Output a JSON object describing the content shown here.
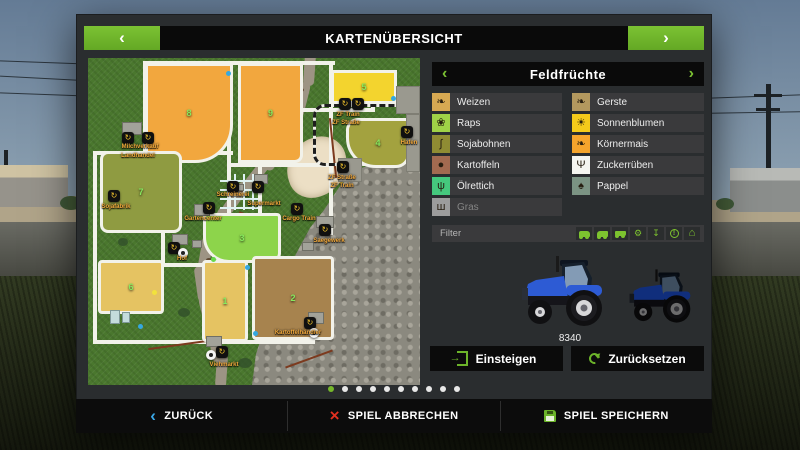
{
  "header": {
    "title": "KARTENÜBERSICHT",
    "prev_icon": "‹",
    "next_icon": "›"
  },
  "panel": {
    "title": "Feldfrüchte",
    "prev_icon": "‹",
    "next_icon": "›",
    "crops_left": [
      {
        "label": "Weizen",
        "tile": "#d7a952",
        "glyph": "❧"
      },
      {
        "label": "Raps",
        "tile": "#9fd247",
        "glyph": "❀"
      },
      {
        "label": "Sojabohnen",
        "tile": "#8f8c33",
        "glyph": "∫"
      },
      {
        "label": "Kartoffeln",
        "tile": "#a26a50",
        "glyph": "●"
      },
      {
        "label": "Ölrettich",
        "tile": "#45c87d",
        "glyph": "ψ"
      },
      {
        "label": "Gras",
        "tile": "#9c9c9c",
        "glyph": "ш"
      }
    ],
    "crops_right": [
      {
        "label": "Gerste",
        "tile": "#b3985e",
        "glyph": "❧"
      },
      {
        "label": "Sonnenblumen",
        "tile": "#f4ca1a",
        "glyph": "☀"
      },
      {
        "label": "Körnermais",
        "tile": "#f5a42c",
        "glyph": "❧"
      },
      {
        "label": "Zuckerrüben",
        "tile": "#f5f5f0",
        "glyph": "Ψ"
      },
      {
        "label": "Pappel",
        "tile": "#7b9383",
        "glyph": "♠"
      }
    ],
    "filter_label": "Filter",
    "filter_icons": [
      "tractor",
      "harvester",
      "trailer",
      "production",
      "download",
      "info",
      "house"
    ],
    "vehicle_id": "8340",
    "enter_button": "Einsteigen",
    "reset_button": "Zurücksetzen",
    "accent_green": "#6fb52b"
  },
  "map": {
    "fields": [
      {
        "num": "8",
        "color": "#f2a73e"
      },
      {
        "num": "9",
        "color": "#f2a73e"
      },
      {
        "num": "5",
        "color": "#f3d42e"
      },
      {
        "num": "4",
        "color": "#a3a23f"
      },
      {
        "num": "7",
        "color": "#8f9b41"
      },
      {
        "num": "3",
        "color": "#8dd44b"
      },
      {
        "num": "6",
        "color": "#e5c362"
      },
      {
        "num": "1",
        "color": "#e5c362"
      },
      {
        "num": "2",
        "color": "#a7834e"
      }
    ],
    "labels": [
      "Milchverkauf",
      "Landhandel",
      "Sojafabrik",
      "Hof",
      "Schreinerei",
      "Supermarkt",
      "Gartencenter",
      "Cargo Train",
      "Saegewerk",
      "ZF Train",
      "ZF Straße",
      "ZF Straße",
      "ZF Train",
      "Hafen",
      "Viehmarkt",
      "Kartoffelhändler"
    ]
  },
  "footer": {
    "back": "ZURÜCK",
    "cancel": "SPIEL ABBRECHEN",
    "save": "SPIEL SPEICHERN"
  }
}
